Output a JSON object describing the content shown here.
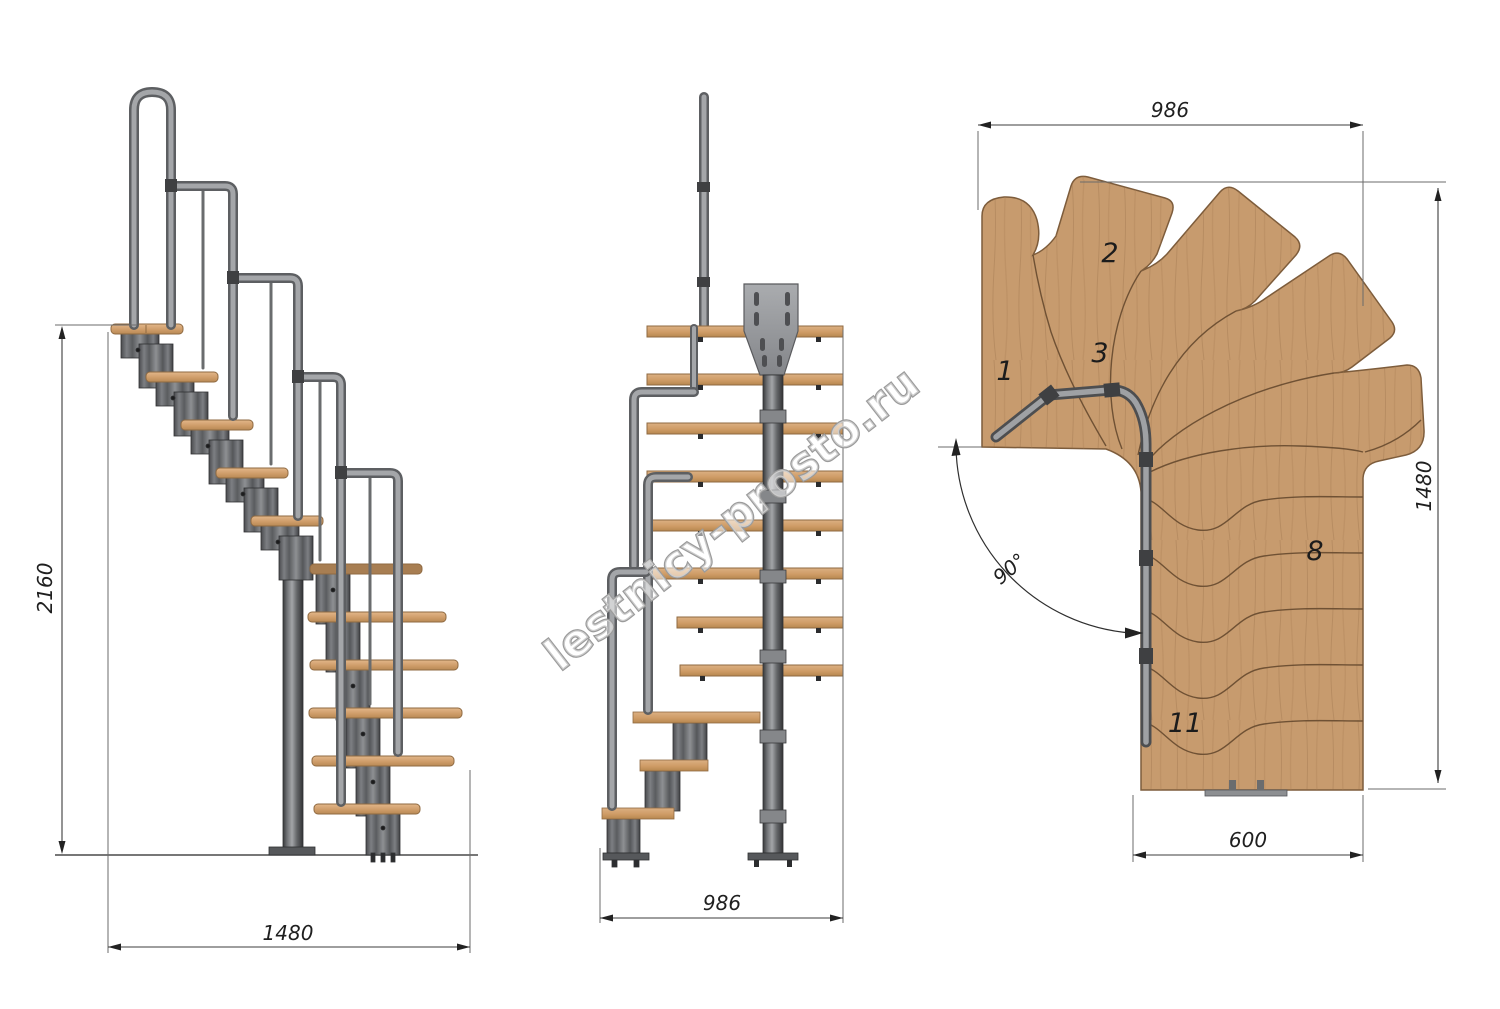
{
  "drawing": {
    "watermark": "lestnicy-prosto.ru",
    "background": "#ffffff"
  },
  "side_view": {
    "name": "side elevation of modular staircase",
    "height_dim": "2160",
    "width_dim": "1480"
  },
  "front_view": {
    "name": "front elevation of modular staircase",
    "width_dim": "986"
  },
  "plan_view": {
    "name": "plan view of modular staircase",
    "width_dim": "986",
    "depth_dim": "1480",
    "flight_width_dim": "600",
    "turn_angle": "90°",
    "step_numbers": [
      "1",
      "2",
      "3",
      "8",
      "11"
    ]
  },
  "colors": {
    "wood": "#c79b6e",
    "wood_dark": "#7d5c3b",
    "metal": "#6d6f72",
    "metal_dark": "#3f4042",
    "metal_light": "#a6a8ab",
    "dim_line": "#3c3c3c",
    "text": "#1f1f1f",
    "watermark_gray": "#9b9b9b"
  }
}
